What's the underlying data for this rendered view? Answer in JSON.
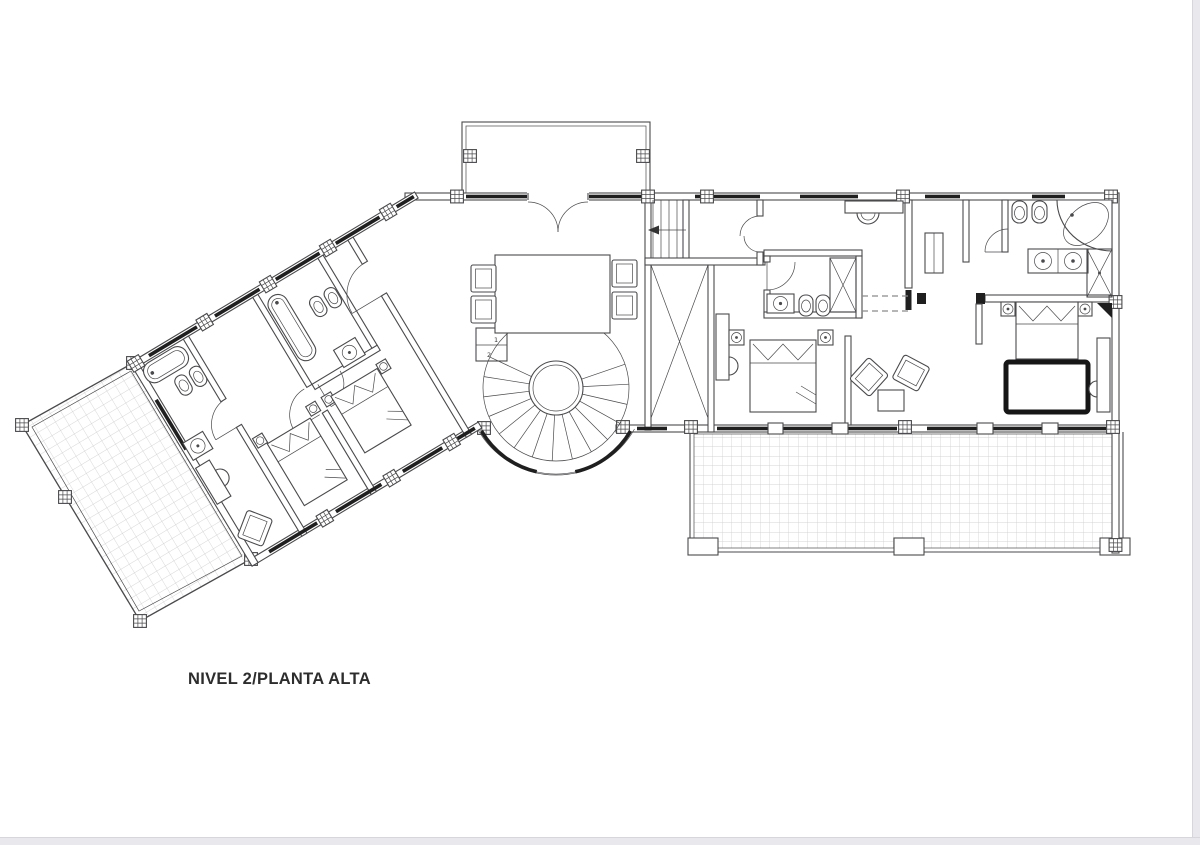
{
  "plan": {
    "title": "NIVEL 2/PLANTA ALTA",
    "stair_step_labels": [
      "1",
      "2"
    ],
    "colors": {
      "paper": "#ffffff",
      "line": "#4a4a4d",
      "window": "#1f1f1f",
      "grid": "#c9c9c9",
      "label": "#2d2d2d",
      "page_edge": "#e9e9ed",
      "rug_border": "#161616"
    }
  }
}
